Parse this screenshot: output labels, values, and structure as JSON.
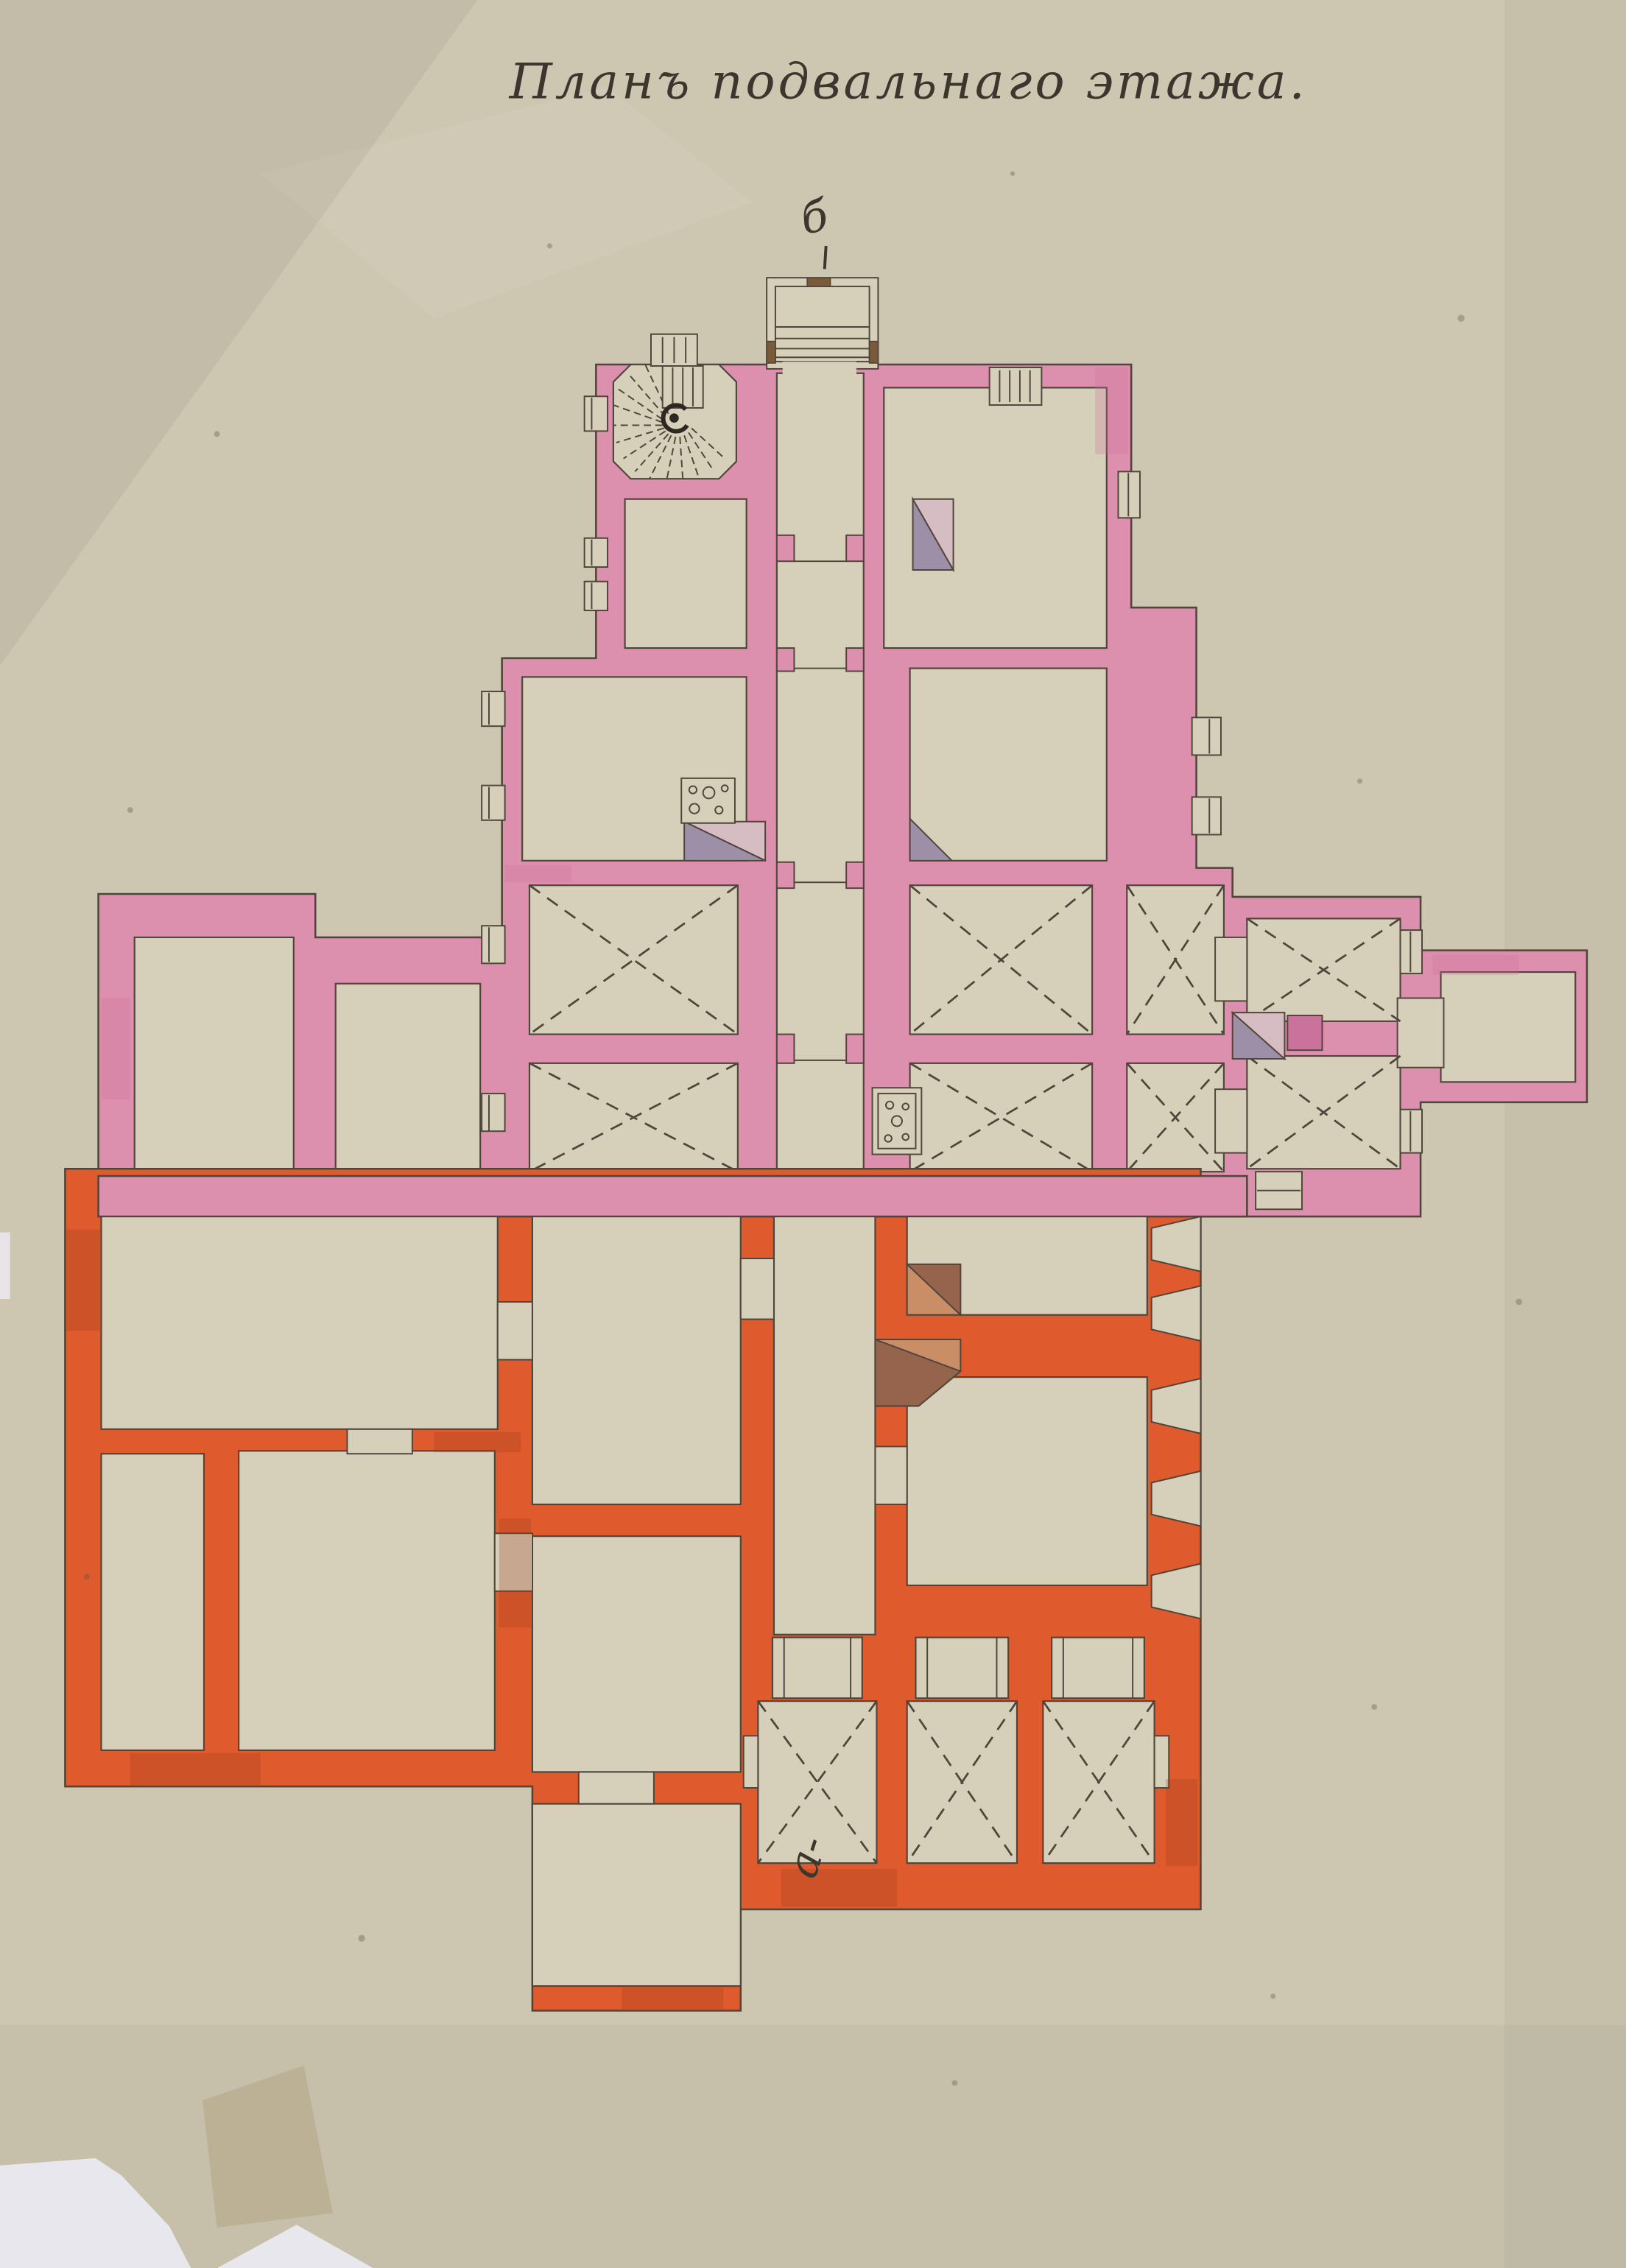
{
  "document": {
    "title": "Планъ подвальнаго этажа.",
    "language": "Russian (pre-reform orthography)",
    "section_marks": {
      "top": "б",
      "bottom": "а-"
    }
  },
  "palette": {
    "paper": "#cdc7b1",
    "paper_room": "#d6d0bb",
    "pink_wall": "#dd8fae",
    "pink_wall_dark": "#cb729c",
    "orange_wall": "#df5a2c",
    "orange_wall_dark": "#a03d1b",
    "line": "#50453a",
    "ink": "#3c362e",
    "lilac": "#9d8fa8",
    "pale_pink": "#d6bdc3",
    "tan": "#c98e66",
    "tan_dark": "#96644c",
    "post_brown": "#7a5a38",
    "backing_white": "#e9e7ee",
    "stain": "#b5a383"
  },
  "features": [
    {
      "name": "entrance-porch-with-steps",
      "location": "top center"
    },
    {
      "name": "spiral-staircase-octagonal",
      "location": "upper left of north block"
    },
    {
      "name": "secondary-steps",
      "location": "north wall, right of porch"
    },
    {
      "name": "central-corridor",
      "location": "vertical axis below porch"
    },
    {
      "name": "vaulted-cellar-rooms-dashed-cross",
      "count": 11
    },
    {
      "name": "stove-with-burner-circles",
      "count": 2
    },
    {
      "name": "corner-stove-triangles-lilac",
      "count": 4
    },
    {
      "name": "corner-stove-triangles-tan",
      "count": 2
    },
    {
      "name": "window-niches",
      "location": "outer walls"
    },
    {
      "name": "left-annex-two-rooms",
      "wall_color_key": "pink_wall"
    },
    {
      "name": "east-corridor-arm",
      "wall_color_key": "pink_wall"
    },
    {
      "name": "lower-building",
      "wall_color_key": "orange_wall"
    },
    {
      "name": "upper-building",
      "wall_color_key": "pink_wall"
    },
    {
      "name": "torn-paper-corner",
      "location": "bottom left"
    }
  ]
}
